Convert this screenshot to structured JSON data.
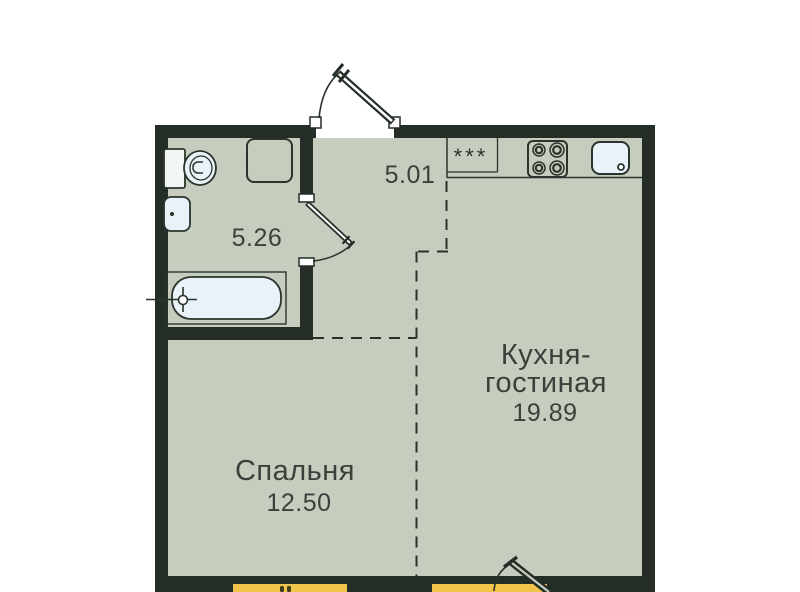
{
  "plan": {
    "title": "apartment-floor-plan",
    "rooms": {
      "kitchen_living": {
        "name_line1": "Кухня-",
        "name_line2": "гостиная",
        "area": "19.89"
      },
      "bedroom": {
        "name": "Спальня",
        "area": "12.50"
      },
      "bathroom": {
        "area": "5.26"
      },
      "hallway": {
        "area": "5.01"
      }
    },
    "symbols": {
      "fridge_stars": "***"
    },
    "colors": {
      "wall": "#242e27",
      "floor": "#c6cdbe",
      "background": "#ffffff",
      "window_accent": "#f0c34b",
      "fixture_fill": "#e8f2f8",
      "label_text": "#3a413c"
    }
  }
}
